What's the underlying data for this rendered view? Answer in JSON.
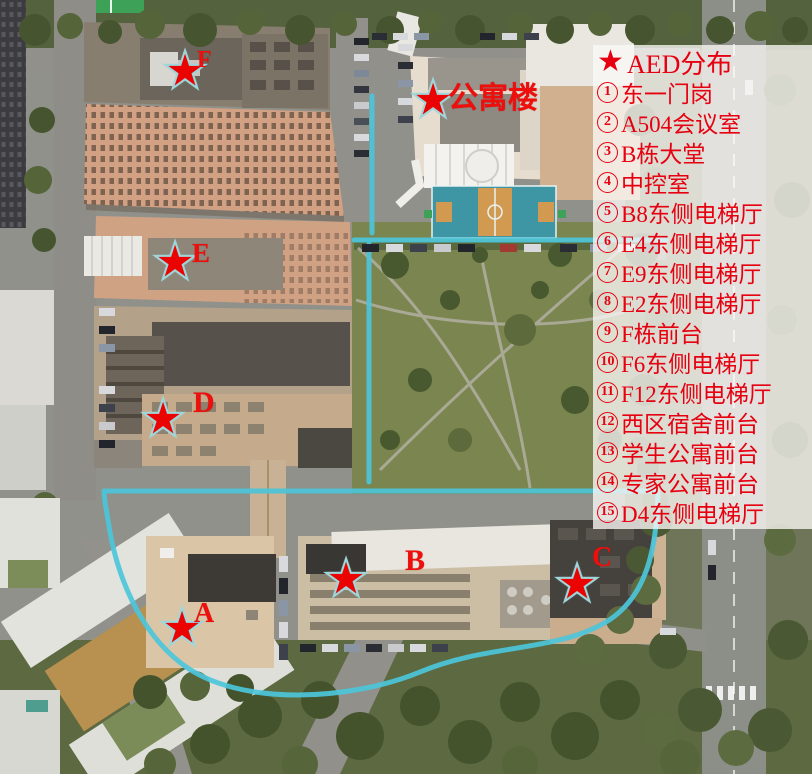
{
  "map": {
    "star_glyph": "★",
    "markers": [
      {
        "id": "building-f",
        "label": "F"
      },
      {
        "id": "apartment-building",
        "label": "公寓楼"
      },
      {
        "id": "building-e",
        "label": "E"
      },
      {
        "id": "building-d",
        "label": "D"
      },
      {
        "id": "building-a",
        "label": "A"
      },
      {
        "id": "building-b",
        "label": "B"
      },
      {
        "id": "building-c",
        "label": "C"
      }
    ],
    "features": {
      "basketball_court": "basketball-court",
      "park": "central-park",
      "jogging_path_color": "#4cc5da"
    }
  },
  "legend": {
    "star_glyph": "★",
    "title": "AED分布",
    "items": [
      {
        "num": "1",
        "label": "东一门岗"
      },
      {
        "num": "2",
        "label": "A504会议室"
      },
      {
        "num": "3",
        "label": "B栋大堂"
      },
      {
        "num": "4",
        "label": "中控室"
      },
      {
        "num": "5",
        "label": "B8东侧电梯厅"
      },
      {
        "num": "6",
        "label": "E4东侧电梯厅"
      },
      {
        "num": "7",
        "label": "E9东侧电梯厅"
      },
      {
        "num": "8",
        "label": "E2东侧电梯厅"
      },
      {
        "num": "9",
        "label": "F栋前台"
      },
      {
        "num": "10",
        "label": "F6东侧电梯厅"
      },
      {
        "num": "11",
        "label": "F12东侧电梯厅"
      },
      {
        "num": "12",
        "label": "西区宿舍前台"
      },
      {
        "num": "13",
        "label": "学生公寓前台"
      },
      {
        "num": "14",
        "label": "专家公寓前台"
      },
      {
        "num": "15",
        "label": "D4东侧电梯厅"
      }
    ],
    "colors": {
      "text": "#e60010",
      "panel_bg": "rgba(251,249,246,0.78)",
      "star": "#ea0300"
    }
  }
}
